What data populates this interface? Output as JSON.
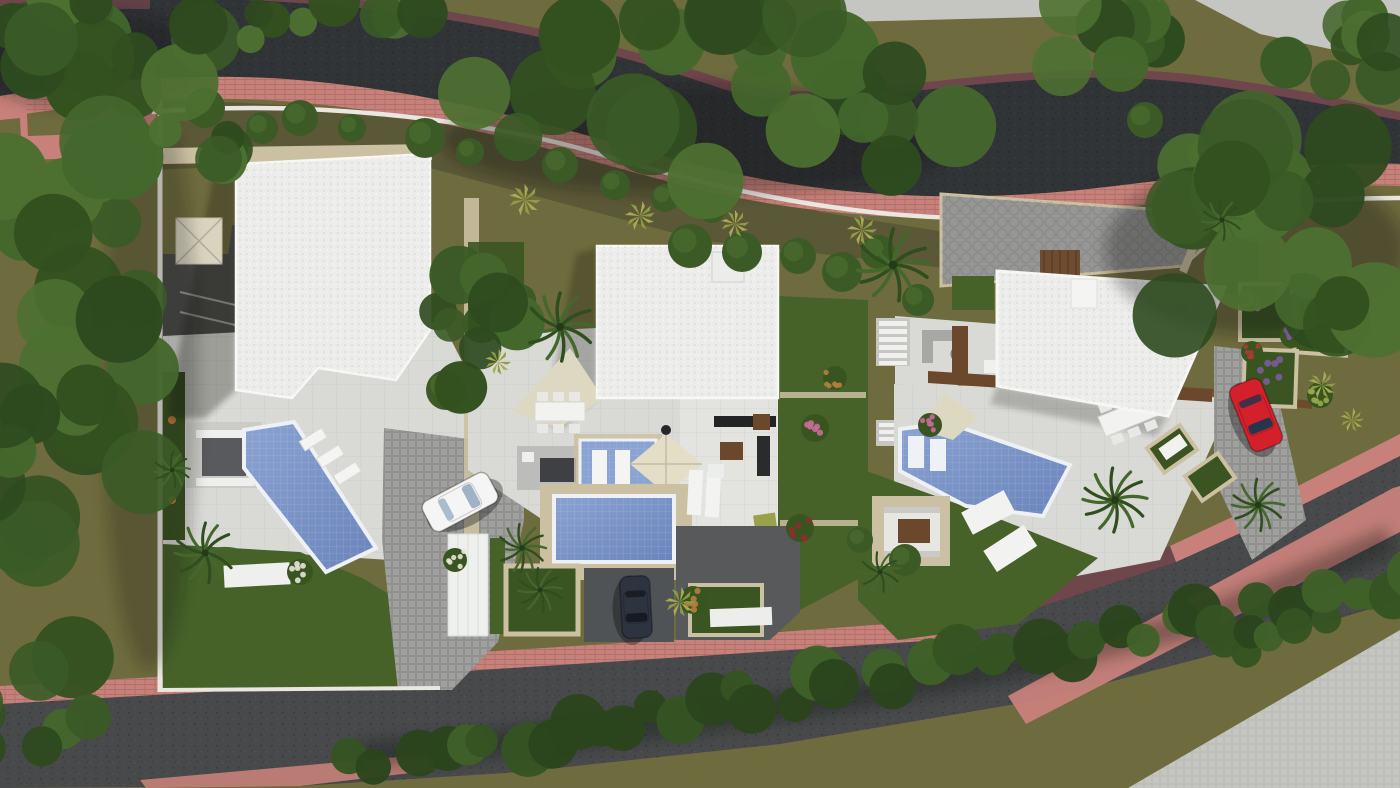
{
  "meta": {
    "title": "Aerial top-down 3D render of three-villa residential development",
    "view": "top-down site plan render",
    "counts": {
      "villas": 3,
      "pools": 4,
      "cars": 3,
      "roads": 2
    }
  },
  "palette": {
    "oliveBase": "#6e6b3e",
    "oliveShade": "#4a4830",
    "topRoad": "#313437",
    "bottomRoad": "#47494b",
    "sidewalkPink": "#c8817a",
    "sidewalkMaroon": "#6f464c",
    "wallWhite": "#e9e7e0",
    "travertine": "#cbc0a1",
    "roofWhite": "#ececea",
    "terrace": "#d9dad6",
    "terraceBright": "#e3e3df",
    "cobble": "#a0a19f",
    "courtGray": "#969795",
    "concrete": "#c5c5c1",
    "lawn": "#466229",
    "lawnDark": "#3a5422",
    "poolLight": "#8ba3d2",
    "poolDark": "#6a84bb",
    "wood": "#6b482b",
    "darkDrivePaving": "#4b4b49",
    "asphaltDrive": "#505356",
    "shadedZone": "#57595b",
    "canopyGreens": "#3a5a26",
    "carWhite": "#f4f5f4",
    "carDark": "#2e3340",
    "carRed": "#d3202a"
  },
  "scene": {
    "vegetation": {
      "clusterGreens": [
        "#2e4a1f",
        "#3a5a26",
        "#44672c",
        "#33511f",
        "#4d7031"
      ],
      "hedgeGreens": [
        "#2b451c",
        "#355322",
        "#3f6128"
      ],
      "clusters": [
        {
          "x": 95,
          "y": 45,
          "rx": 115,
          "ry": 58,
          "n": 16,
          "rmin": 20,
          "rmax": 40,
          "seed": 1
        },
        {
          "x": 330,
          "y": 22,
          "rx": 105,
          "ry": 30,
          "n": 8,
          "rmin": 14,
          "rmax": 26,
          "seed": 2
        },
        {
          "x": 720,
          "y": 100,
          "rx": 270,
          "ry": 90,
          "n": 26,
          "rmin": 24,
          "rmax": 48,
          "seed": 3
        },
        {
          "x": 1085,
          "y": 35,
          "rx": 105,
          "ry": 40,
          "n": 9,
          "rmin": 18,
          "rmax": 32,
          "seed": 4
        },
        {
          "x": 1275,
          "y": 245,
          "rx": 140,
          "ry": 120,
          "n": 20,
          "rmin": 26,
          "rmax": 50,
          "seed": 5
        },
        {
          "x": 1335,
          "y": 45,
          "rx": 80,
          "ry": 50,
          "n": 8,
          "rmin": 18,
          "rmax": 34,
          "seed": 6
        },
        {
          "x": 65,
          "y": 390,
          "rx": 92,
          "ry": 295,
          "n": 28,
          "rmin": 24,
          "rmax": 46,
          "seed": 7
        },
        {
          "x": 35,
          "y": 725,
          "rx": 65,
          "ry": 55,
          "n": 7,
          "rmin": 18,
          "rmax": 30,
          "seed": 8
        },
        {
          "x": 225,
          "y": 128,
          "rx": 62,
          "ry": 38,
          "n": 6,
          "rmin": 14,
          "rmax": 26,
          "seed": 11
        },
        {
          "x": 470,
          "y": 300,
          "rx": 58,
          "ry": 92,
          "n": 10,
          "rmin": 16,
          "rmax": 30,
          "seed": 12
        }
      ],
      "hedgeBands": [
        {
          "x0": 355,
          "y0": 762,
          "x1": 1255,
          "y1": 614,
          "n": 34,
          "rmin": 16,
          "rmax": 29,
          "seed": 9
        },
        {
          "x0": 1220,
          "y0": 650,
          "x1": 1400,
          "y1": 574,
          "n": 12,
          "rmin": 14,
          "rmax": 26,
          "seed": 10
        }
      ],
      "shrubs": [
        {
          "x": 205,
          "y": 108,
          "r": 20
        },
        {
          "x": 262,
          "y": 128,
          "r": 16
        },
        {
          "x": 300,
          "y": 118,
          "r": 18
        },
        {
          "x": 352,
          "y": 128,
          "r": 14
        },
        {
          "x": 425,
          "y": 138,
          "r": 20
        },
        {
          "x": 470,
          "y": 152,
          "r": 14
        },
        {
          "x": 560,
          "y": 165,
          "r": 18
        },
        {
          "x": 615,
          "y": 185,
          "r": 15
        },
        {
          "x": 665,
          "y": 198,
          "r": 14
        },
        {
          "x": 712,
          "y": 210,
          "r": 13
        },
        {
          "x": 690,
          "y": 246,
          "r": 22
        },
        {
          "x": 742,
          "y": 252,
          "r": 20
        },
        {
          "x": 798,
          "y": 256,
          "r": 18
        },
        {
          "x": 842,
          "y": 272,
          "r": 20
        },
        {
          "x": 878,
          "y": 252,
          "r": 17
        },
        {
          "x": 918,
          "y": 300,
          "r": 16
        },
        {
          "x": 905,
          "y": 560,
          "r": 16
        },
        {
          "x": 860,
          "y": 540,
          "r": 13
        },
        {
          "x": 1210,
          "y": 155,
          "r": 22
        },
        {
          "x": 1145,
          "y": 120,
          "r": 18
        },
        {
          "x": 446,
          "y": 390,
          "r": 20
        },
        {
          "x": 520,
          "y": 300,
          "r": 16
        }
      ],
      "flowerShrubs": [
        {
          "x": 815,
          "y": 428,
          "r": 14,
          "color": "#c96c9b"
        },
        {
          "x": 930,
          "y": 425,
          "r": 12,
          "color": "#c96c9b"
        },
        {
          "x": 300,
          "y": 572,
          "r": 13,
          "color": "#e8e4da"
        },
        {
          "x": 455,
          "y": 560,
          "r": 12,
          "color": "#e8e4da"
        },
        {
          "x": 800,
          "y": 528,
          "r": 14,
          "color": "#8c2f2c"
        },
        {
          "x": 1270,
          "y": 370,
          "r": 16,
          "color": "#7b5a9e"
        },
        {
          "x": 1292,
          "y": 336,
          "r": 12,
          "color": "#7b5a9e"
        },
        {
          "x": 1250,
          "y": 300,
          "r": 12,
          "color": "#7b5a9e"
        },
        {
          "x": 1252,
          "y": 352,
          "r": 11,
          "color": "#b03a36"
        },
        {
          "x": 693,
          "y": 600,
          "r": 14,
          "color": "#b4803f"
        },
        {
          "x": 835,
          "y": 378,
          "r": 12,
          "color": "#b4803f"
        },
        {
          "x": 1320,
          "y": 395,
          "r": 13,
          "color": "#9aa94e"
        }
      ],
      "palms": [
        {
          "x": 205,
          "y": 553,
          "s": 30
        },
        {
          "x": 560,
          "y": 327,
          "s": 34
        },
        {
          "x": 522,
          "y": 548,
          "s": 24
        },
        {
          "x": 540,
          "y": 590,
          "s": 22
        },
        {
          "x": 893,
          "y": 265,
          "s": 36
        },
        {
          "x": 1115,
          "y": 500,
          "s": 32
        },
        {
          "x": 1258,
          "y": 505,
          "s": 26
        },
        {
          "x": 880,
          "y": 572,
          "s": 20
        },
        {
          "x": 1222,
          "y": 220,
          "s": 20
        },
        {
          "x": 172,
          "y": 470,
          "s": 18
        }
      ],
      "agaves": [
        {
          "x": 525,
          "y": 200,
          "s": 16
        },
        {
          "x": 640,
          "y": 216,
          "s": 15
        },
        {
          "x": 735,
          "y": 224,
          "s": 14
        },
        {
          "x": 862,
          "y": 230,
          "s": 15
        },
        {
          "x": 680,
          "y": 602,
          "s": 15
        },
        {
          "x": 1322,
          "y": 385,
          "s": 14
        },
        {
          "x": 1352,
          "y": 420,
          "s": 12
        },
        {
          "x": 498,
          "y": 362,
          "s": 13
        }
      ]
    },
    "cars": [
      {
        "name": "white-car",
        "cx": 460,
        "cy": 502,
        "angle": -28,
        "len": 74,
        "wid": 34,
        "bodyKey": "carWhite",
        "glass": "#9fb2c8"
      },
      {
        "name": "dark-car",
        "cx": 636,
        "cy": 607,
        "angle": 87,
        "len": 62,
        "wid": 30,
        "bodyKey": "carDark",
        "glass": "#161a22"
      },
      {
        "name": "red-car",
        "cx": 1256,
        "cy": 415,
        "angle": 68,
        "len": 70,
        "wid": 34,
        "bodyKey": "carRed",
        "glass": "#27344d"
      }
    ]
  }
}
